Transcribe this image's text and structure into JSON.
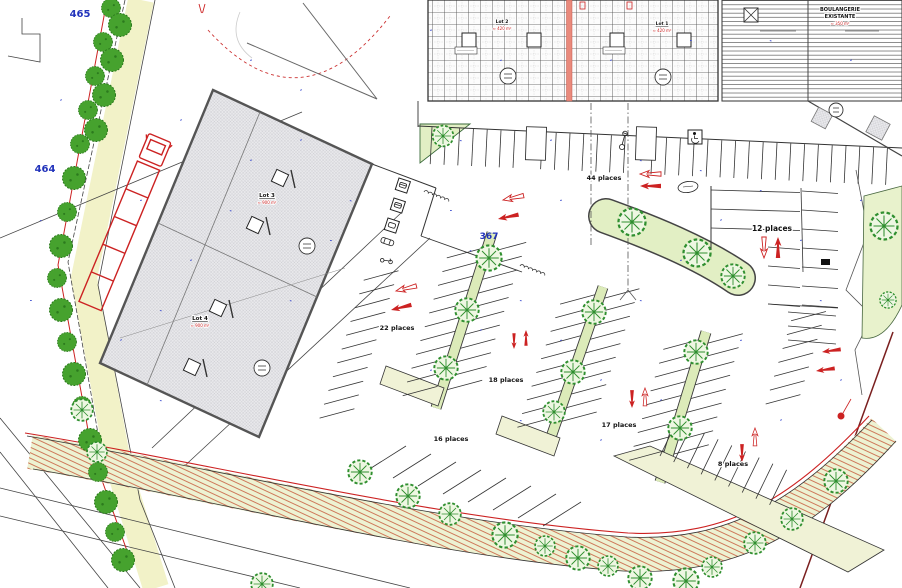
{
  "plan": {
    "parcels": {
      "p465": "465",
      "p464": "464",
      "p367": "367"
    },
    "lots": {
      "lot1": {
        "name": "Lot 1",
        "note": "≈ 420 m²"
      },
      "lot2": {
        "name": "Lot 2",
        "note": "≈ 420 m²"
      },
      "lot3": {
        "name": "Lot 3",
        "note": "≈ 900 m²"
      },
      "lot4": {
        "name": "Lot 4",
        "note": "≈ 900 m²"
      },
      "bakery": {
        "line1": "BOULANGERIE",
        "line2": "EXISTANTE",
        "note": "≈ 350 m²"
      }
    },
    "parking": {
      "p44": "44 places",
      "p22": "22 places",
      "p18": "18 places",
      "p17": "17 places",
      "p16": "16 places",
      "p12": "12 places",
      "p8": "8 places"
    },
    "icons": [
      "wheelchair-icon",
      "motorcycle-icon",
      "car-icon",
      "scooter-icon",
      "truck-icon",
      "tree-icon",
      "hedge-icon",
      "direction-arrow-icon"
    ],
    "colors": {
      "parcel_blue": "#2233bb",
      "annotation_red": "#cc2222",
      "vegetation_green": "#2f8f2f",
      "island_fill": "#eef0d2",
      "building_gray": "#e9e9ec",
      "divider_stripe": "#e98a7c"
    }
  }
}
